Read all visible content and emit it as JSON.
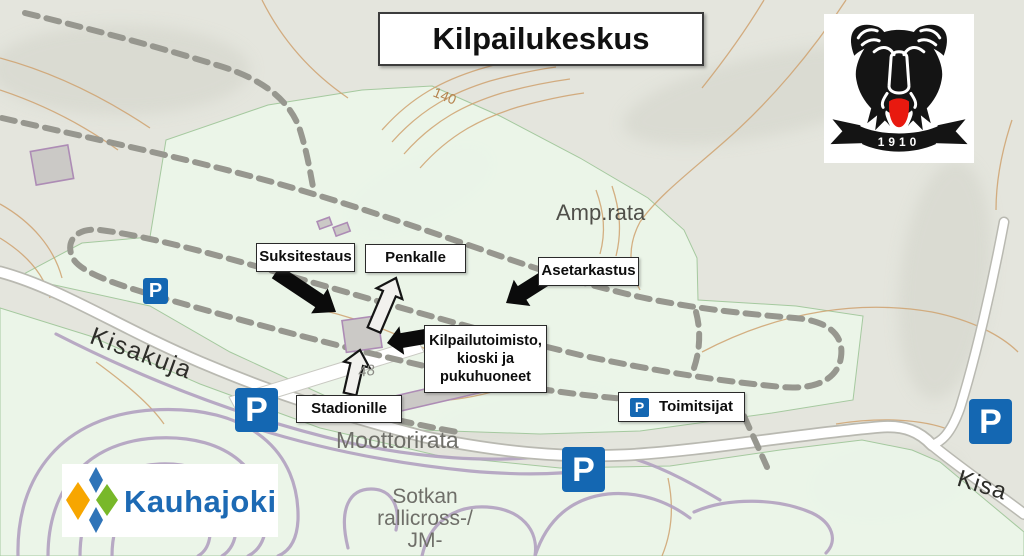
{
  "title": "Kilpailukeskus",
  "logos": {
    "club_banner_year": "1910",
    "municipality_name": "Kauhajoki"
  },
  "callouts": {
    "suksitestaus": "Suksitestaus",
    "penkalle": "Penkalle",
    "asetarkastus": "Asetarkastus",
    "kilpailutoimisto": [
      "Kilpailutoimisto,",
      "kioski ja",
      "pukuhuoneet"
    ],
    "stadionille": "Stadionille",
    "toimitsijat": "Toimitsijat"
  },
  "map_labels": {
    "amp_rata": "Amp.rata",
    "kisakuja": "Kisakuja",
    "moottorirata": "Moottorirata",
    "sotkan": [
      "Sotkan",
      "rallicross-/",
      "JM-"
    ],
    "kisa_southeast": "Kisa",
    "contour_140": "140",
    "elevation_48": "48"
  },
  "parking": {
    "letter": "P",
    "sign_color": "#1467b2"
  },
  "colors": {
    "field_green": "#ebf5e9",
    "terrain_gray": "#e4e5dd",
    "contour_orange": "#cfa26f",
    "ski_track_gray": "#97978f",
    "rallicross_purple": "#b2a1c0",
    "building_outline_purple": "#ad8cb5",
    "road_white": "#ffffff",
    "kauhajoki_blue": "#1d6ab4",
    "kauhajoki_orange": "#f7a600",
    "kauhajoki_green": "#78b829",
    "bear_black": "#141414",
    "bear_tongue_red": "#e8190f"
  }
}
